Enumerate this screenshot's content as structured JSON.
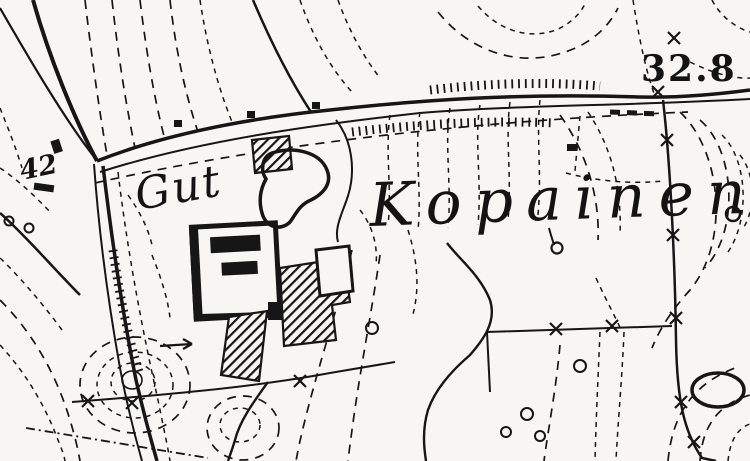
{
  "map": {
    "type": "historical-topographic-map",
    "labels": {
      "estate": "Gut",
      "place": "Kopainen",
      "elevation": "32.8",
      "road_number": "42"
    },
    "colors": {
      "ink": "#161616",
      "paper": "#f7f6f2"
    },
    "features": [
      "contour-lines",
      "main-road",
      "side-roads",
      "field-path",
      "embankment-hatching",
      "manor-building",
      "hatched-outbuildings",
      "pond",
      "fence-with-crosses",
      "boundary-line",
      "stream",
      "stone-circles",
      "arrow-marker",
      "spring-symbol",
      "hill-rings"
    ]
  }
}
